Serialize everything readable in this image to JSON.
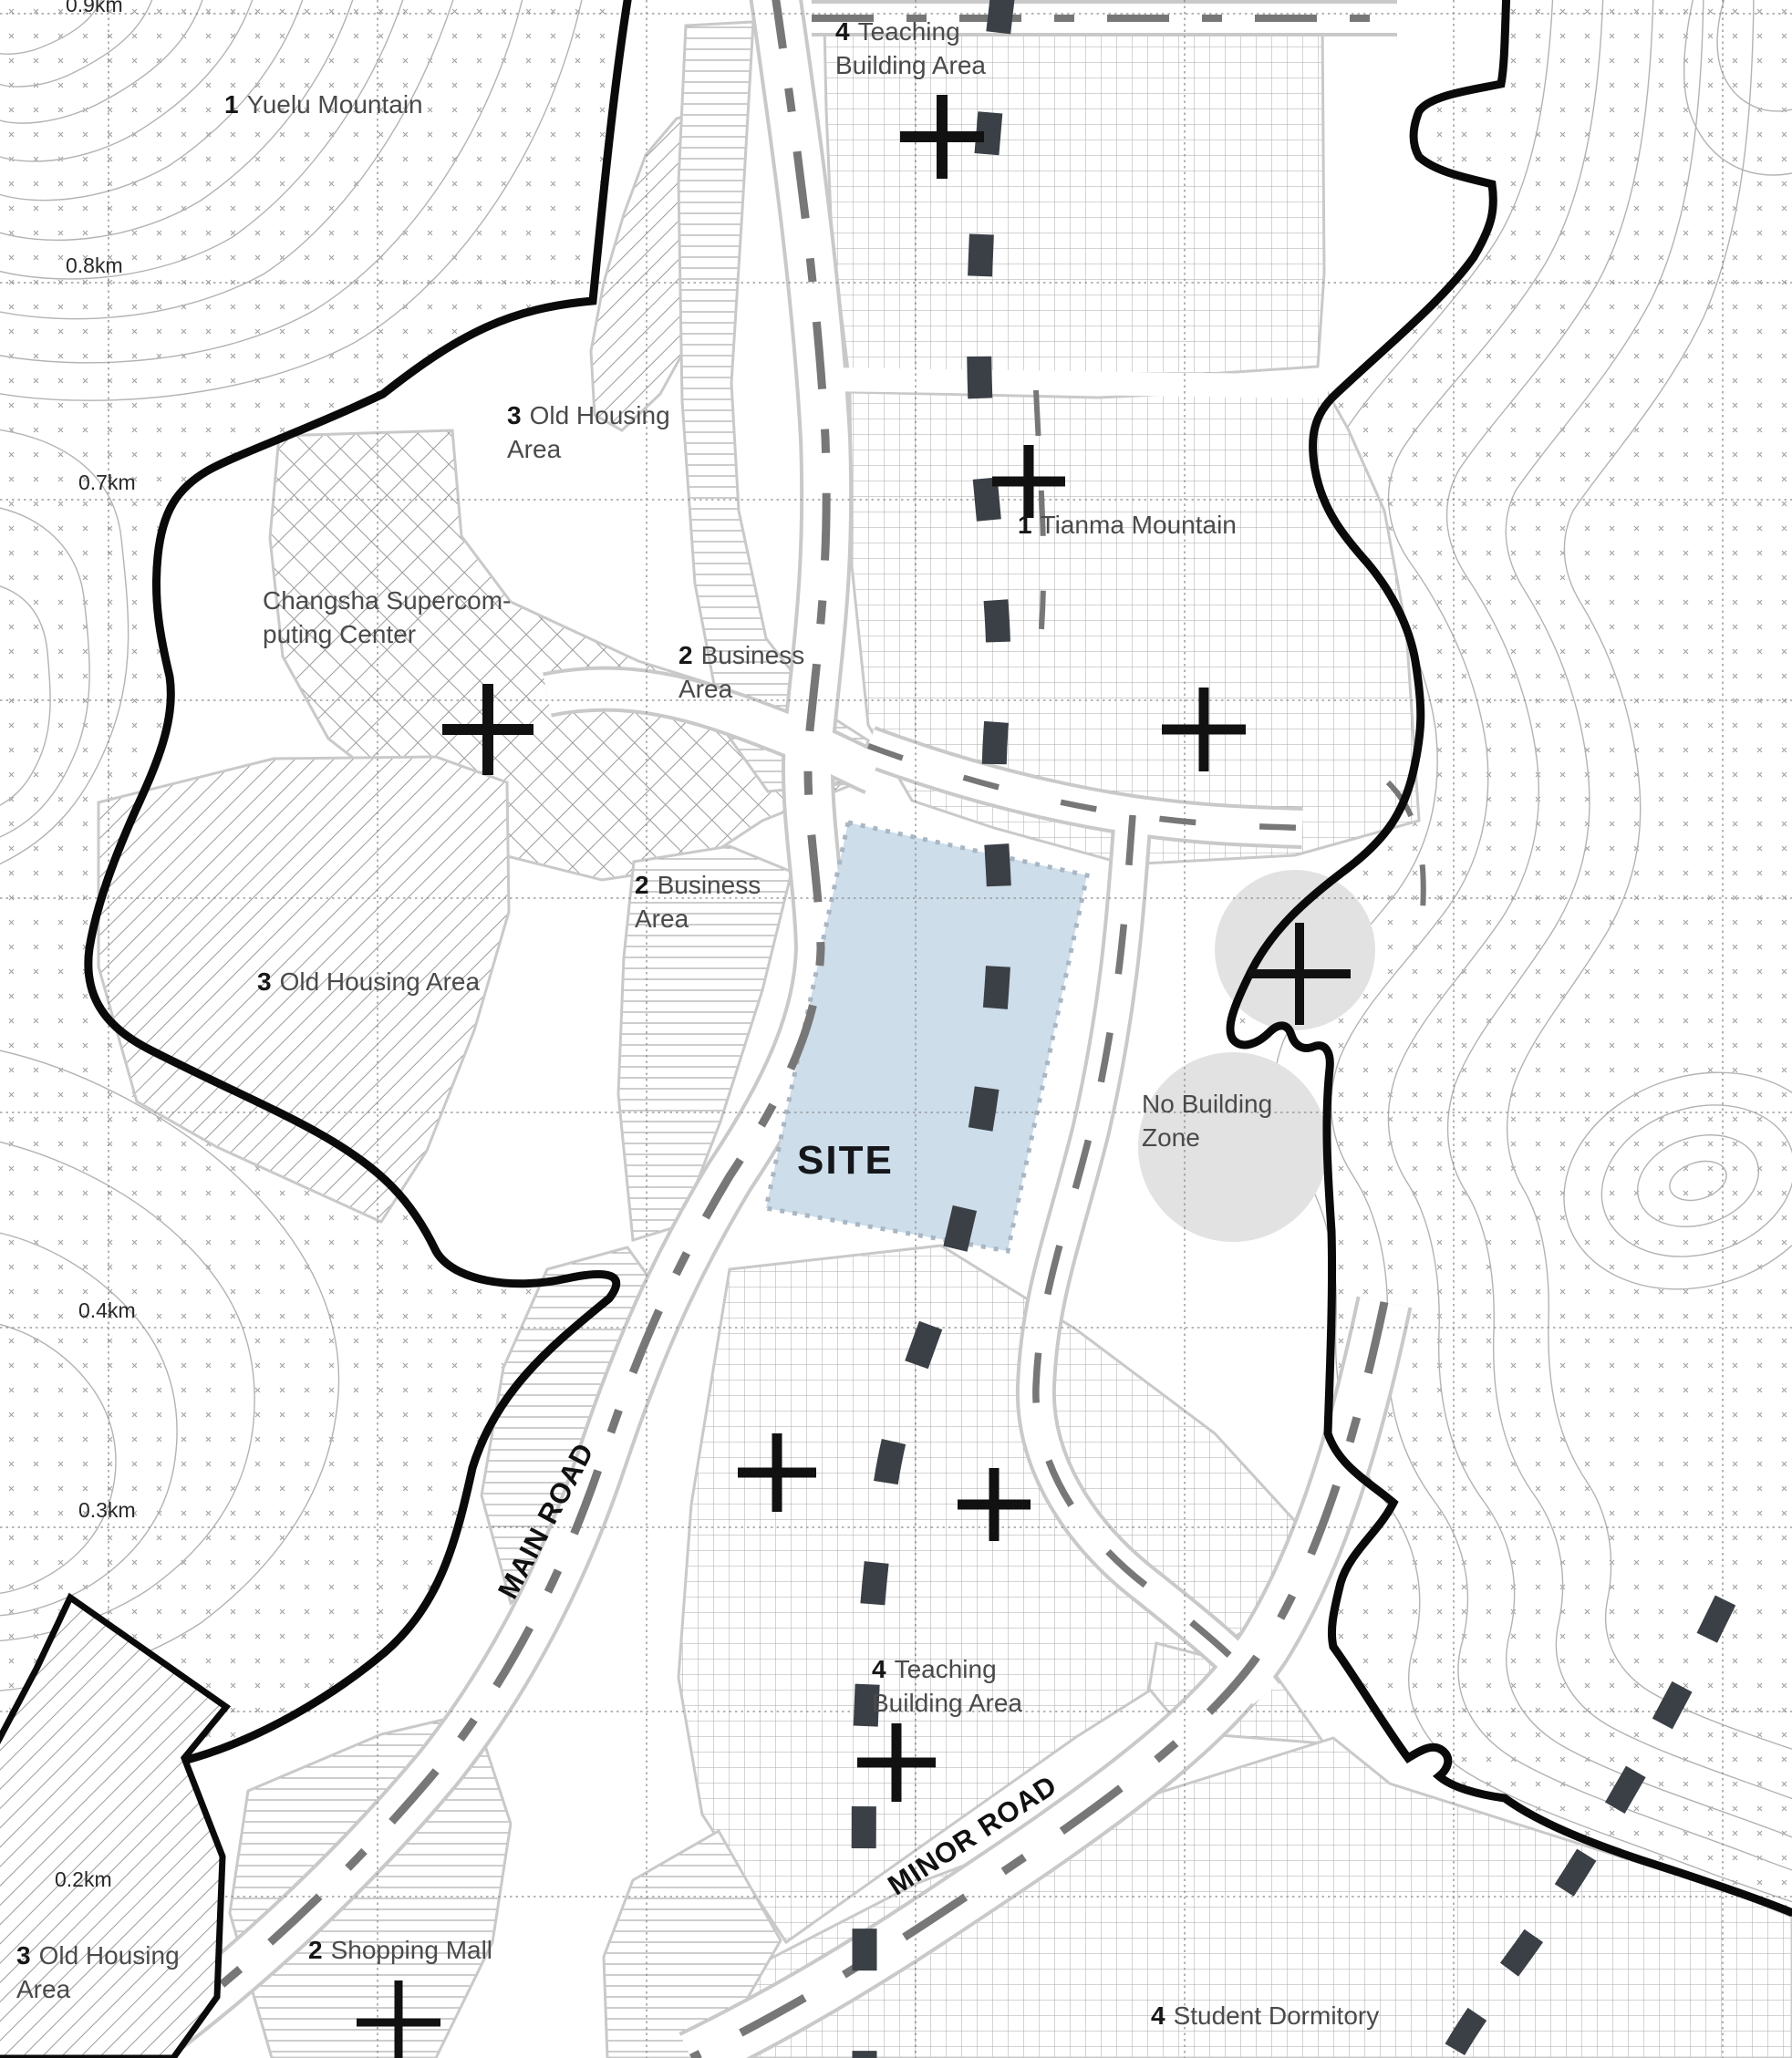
{
  "map_title": "site-analysis-map",
  "areas": {
    "yuelu": {
      "num": "1",
      "name": "Yuelu Mountain"
    },
    "tianma": {
      "num": "1",
      "name": "Tianma Mountain"
    },
    "old_housing_top": {
      "num": "3",
      "line1": "Old Housing",
      "line2": "Area"
    },
    "old_housing_mid": {
      "num": "3",
      "name": "Old Housing Area"
    },
    "old_housing_bottom": {
      "num": "3",
      "line1": "Old Housing",
      "line2": "Area"
    },
    "supercomputing": {
      "line1": "Changsha Supercom-",
      "line2": "puting Center"
    },
    "business_north": {
      "num": "2",
      "line1": "Business",
      "line2": "Area"
    },
    "business_south": {
      "num": "2",
      "line1": "Business",
      "line2": "Area"
    },
    "teaching_north": {
      "num": "4",
      "line1": "Teaching",
      "line2": "Building Area"
    },
    "teaching_south": {
      "num": "4",
      "line1": "Teaching",
      "line2": "Building Area"
    },
    "shopping_mall": {
      "num": "2",
      "name": "Shopping Mall"
    },
    "student_dormitory": {
      "num": "4",
      "name": "Student Dormitory"
    },
    "no_building": {
      "line1": "No Building",
      "line2": "Zone"
    },
    "site": {
      "name": "SITE"
    }
  },
  "roads": {
    "main": "MAIN ROAD",
    "minor": "MINOR ROAD"
  },
  "scale": {
    "k09": "0.9km",
    "k08": "0.8km",
    "k07": "0.7km",
    "k04": "0.4km",
    "k03": "0.3km",
    "k02": "0.2km"
  },
  "colors": {
    "site_fill": "#cdddea",
    "site_border": "#a9b6c3",
    "boundary": "#0a0a0a",
    "no_build_fill": "#e2e2e2",
    "route_dark": "#3b4046",
    "road_dash": "#777777",
    "contour": "#b3b3b3",
    "pattern": "#9b9b9b",
    "grid_line": "#8a8a8a"
  },
  "icons": [
    "plus-icon",
    "contour-pattern",
    "dashed-route"
  ]
}
